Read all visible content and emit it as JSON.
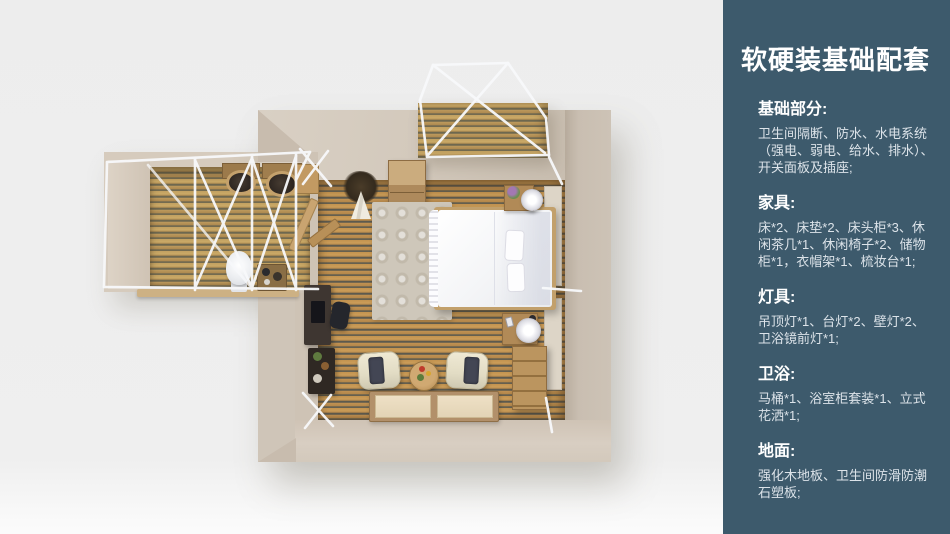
{
  "panel": {
    "title": "软硬装基础配套",
    "colors": {
      "bg": "#3d5a6c",
      "heading": "#ffffff",
      "body": "#dce3e9"
    },
    "sections": [
      {
        "heading": "基础部分:",
        "body": "卫生间隔断、防水、水电系统\n（强电、弱电、给水、排水）、\n开关面板及插座;"
      },
      {
        "heading": "家具:",
        "body": "床*2、床垫*2、床头柜*3、休\n闲茶几*1、休闲椅子*2、储物\n柜*1，衣帽架*1、梳妆台*1;"
      },
      {
        "heading": "灯具:",
        "body": "吊顶灯*1、台灯*2、壁灯*2、\n卫浴镜前灯*1;"
      },
      {
        "heading": "卫浴:",
        "body": "马桶*1、浴室柜套装*1、立式\n花洒*1;"
      },
      {
        "heading": "地面:",
        "body": "强化木地板、卫生间防滑防潮\n石塑板;"
      }
    ]
  }
}
